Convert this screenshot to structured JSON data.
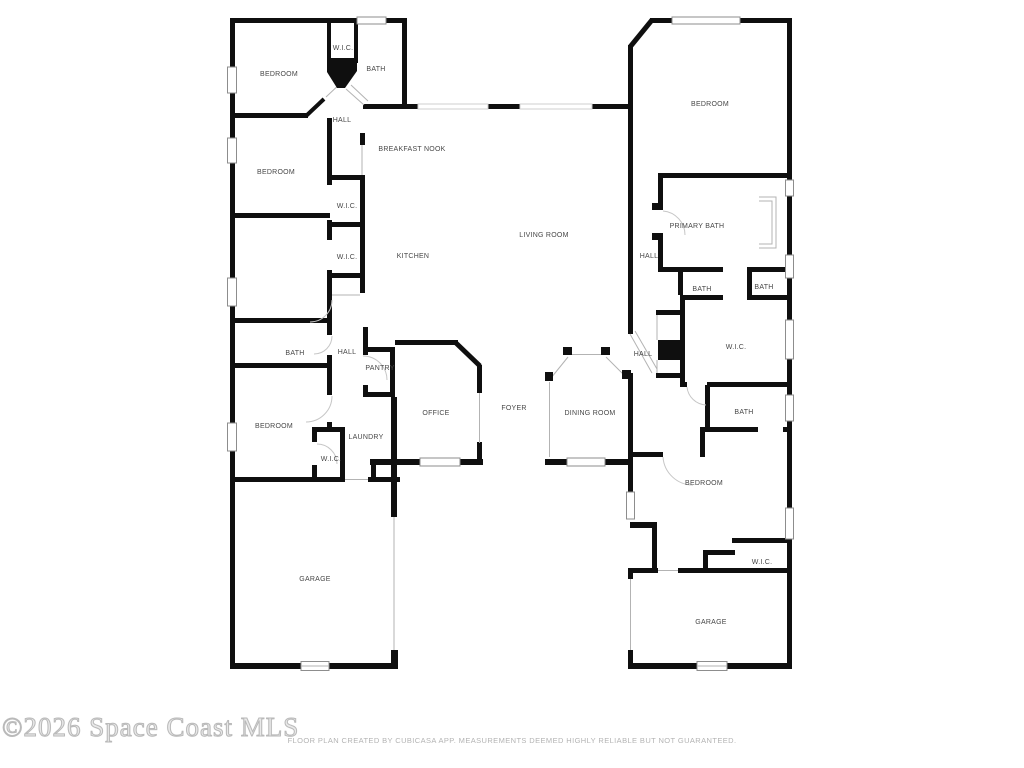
{
  "meta": {
    "type": "floor-plan"
  },
  "colors": {
    "background": "#ffffff",
    "wall": "#0f0f0f",
    "thin_line": "#b3b3b3",
    "window_outline": "#8d8d8d",
    "room_label": "#474747",
    "watermark": "#c9c9c9",
    "disclaimer": "#b3b3b3"
  },
  "rooms": [
    {
      "label": "BEDROOM"
    },
    {
      "label": "W.I.C."
    },
    {
      "label": "BATH"
    },
    {
      "label": "HALL"
    },
    {
      "label": "BREAKFAST NOOK"
    },
    {
      "label": "BEDROOM"
    },
    {
      "label": "W.I.C."
    },
    {
      "label": "KITCHEN"
    },
    {
      "label": "W.I.C."
    },
    {
      "label": "LIVING ROOM"
    },
    {
      "label": "BEDROOM"
    },
    {
      "label": "PRIMARY BATH"
    },
    {
      "label": "HALL"
    },
    {
      "label": "BATH"
    },
    {
      "label": "BATH"
    },
    {
      "label": "W.I.C."
    },
    {
      "label": "HALL"
    },
    {
      "label": "BATH"
    },
    {
      "label": "HALL"
    },
    {
      "label": "PANTRY"
    },
    {
      "label": "OFFICE"
    },
    {
      "label": "FOYER"
    },
    {
      "label": "DINING ROOM"
    },
    {
      "label": "BEDROOM"
    },
    {
      "label": "LAUNDRY"
    },
    {
      "label": "W.I.C."
    },
    {
      "label": "BATH"
    },
    {
      "label": "BEDROOM"
    },
    {
      "label": "W.I.C."
    },
    {
      "label": "GARAGE"
    },
    {
      "label": "GARAGE"
    }
  ],
  "footer": {
    "watermark": "©2026 Space Coast MLS",
    "disclaimer": "FLOOR PLAN CREATED BY CUBICASA APP. MEASUREMENTS DEEMED HIGHLY RELIABLE BUT NOT GUARANTEED."
  }
}
